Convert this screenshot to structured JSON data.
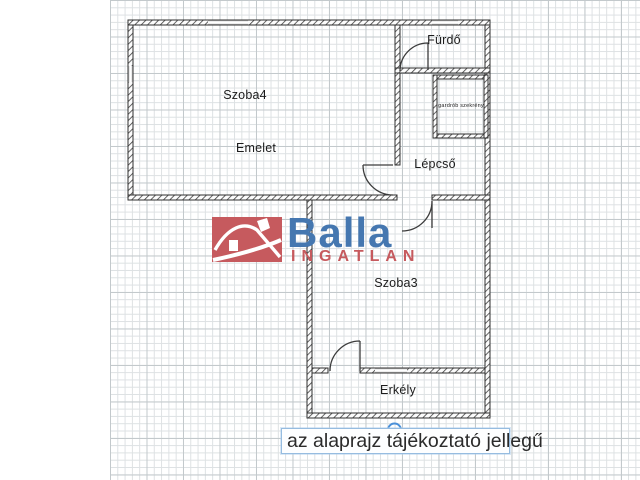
{
  "page": {
    "background": "#ffffff"
  },
  "grid": {
    "left": 110,
    "width": 530,
    "minor_px": 7.3,
    "major_px": 36.5,
    "minor_color": "#dde1e3",
    "major_color": "#c3c9cc"
  },
  "logo": {
    "brand": "Balla",
    "brand_color": "#4577b0",
    "subtitle": "INGATLAN",
    "subtitle_color": "#c65a5e",
    "house_bg": "#c65a5e"
  },
  "caption": {
    "text": "az alaprajz tájékoztató jellegű",
    "border_color": "#96bce0",
    "handle_color": "#4a90d9"
  },
  "floorplan": {
    "wall_color": "#2f2f2f",
    "hatch_color": "#3f3f3f",
    "door_color": "#3c3c3c",
    "window_line_color": "#7a7a7a",
    "rooms": [
      {
        "id": "szoba4",
        "label": "Szoba4",
        "cx": 245,
        "cy": 95,
        "fs": 12.5
      },
      {
        "id": "emelet",
        "label": "Emelet",
        "cx": 256,
        "cy": 148,
        "fs": 12.5
      },
      {
        "id": "furdo",
        "label": "Fürdő",
        "cx": 444,
        "cy": 40,
        "fs": 12.5
      },
      {
        "id": "gardrob",
        "label": "gardrób szekrény",
        "cx": 461,
        "cy": 106,
        "fs": 5.5
      },
      {
        "id": "lepcso",
        "label": "Lépcső",
        "cx": 435,
        "cy": 164,
        "fs": 12.5
      },
      {
        "id": "szoba3",
        "label": "Szoba3",
        "cx": 396,
        "cy": 283,
        "fs": 12.5
      },
      {
        "id": "erkely",
        "label": "Erkély",
        "cx": 398,
        "cy": 390,
        "fs": 12.5
      }
    ],
    "walls": [
      {
        "x": 128,
        "y": 20,
        "w": 362,
        "h": 5
      },
      {
        "x": 128,
        "y": 25,
        "w": 5,
        "h": 175
      },
      {
        "x": 128,
        "y": 195,
        "w": 269,
        "h": 5
      },
      {
        "x": 432,
        "y": 195,
        "w": 58,
        "h": 5
      },
      {
        "x": 485,
        "y": 25,
        "w": 5,
        "h": 170
      },
      {
        "x": 395,
        "y": 25,
        "w": 5,
        "h": 140
      },
      {
        "x": 395,
        "y": 68,
        "w": 95,
        "h": 5
      },
      {
        "x": 433,
        "y": 75,
        "w": 55,
        "h": 4
      },
      {
        "x": 433,
        "y": 134,
        "w": 55,
        "h": 4
      },
      {
        "x": 433,
        "y": 75,
        "w": 4,
        "h": 63
      },
      {
        "x": 484,
        "y": 75,
        "w": 4,
        "h": 63
      },
      {
        "x": 307,
        "y": 200,
        "w": 5,
        "h": 218
      },
      {
        "x": 485,
        "y": 200,
        "w": 5,
        "h": 218
      },
      {
        "x": 307,
        "y": 413,
        "w": 183,
        "h": 5
      },
      {
        "x": 312,
        "y": 368,
        "w": 16,
        "h": 5
      },
      {
        "x": 360,
        "y": 368,
        "w": 125,
        "h": 5
      }
    ],
    "windows": [
      {
        "x": 208,
        "y": 20,
        "w": 40,
        "h": 5
      },
      {
        "x": 128,
        "y": 66,
        "w": 5,
        "h": 16
      },
      {
        "x": 432,
        "y": 20,
        "w": 26,
        "h": 5
      },
      {
        "x": 375,
        "y": 368,
        "w": 32,
        "h": 5
      }
    ],
    "doors": [
      {
        "id": "furdo-door",
        "path": "M 428 43 L 428 70 M 428 43 A 28 28 0 0 0 400 71"
      },
      {
        "id": "emelet-door",
        "path": "M 363 165 L 393 165 M 363 165 A 30 30 0 0 0 393 195"
      },
      {
        "id": "szoba3-door",
        "path": "M 432 201 L 432 228 M 402 231 A 30 30 0 0 0 432 201"
      },
      {
        "id": "erkely-door",
        "path": "M 360 341 L 360 371 M 360 341 A 30 30 0 0 0 330 371"
      }
    ]
  }
}
